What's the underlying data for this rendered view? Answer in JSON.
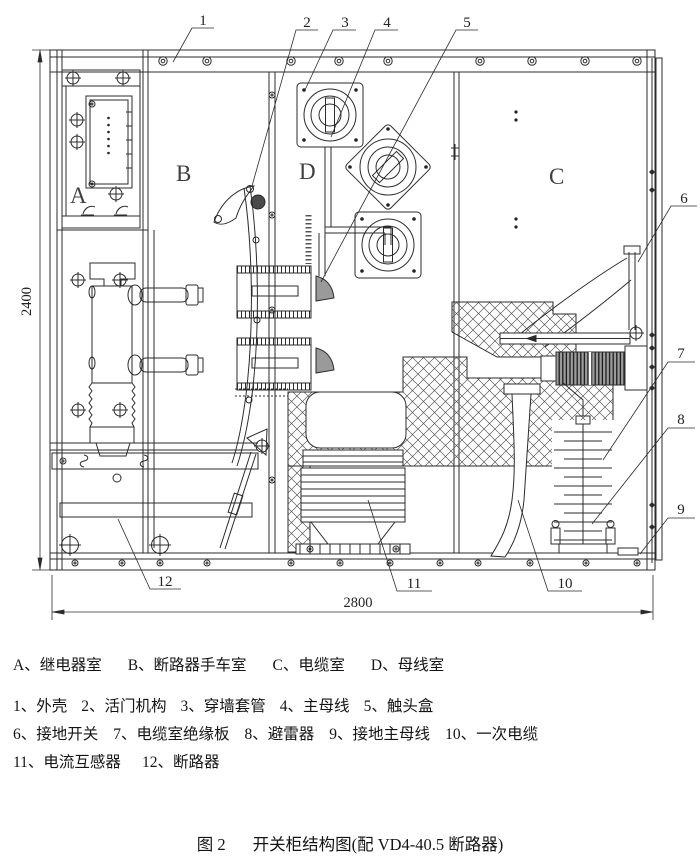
{
  "figure": {
    "dims": {
      "height_mm": "2400",
      "width_mm": "2800"
    },
    "compartments": [
      {
        "id": "A",
        "label": "A"
      },
      {
        "id": "B",
        "label": "B"
      },
      {
        "id": "D",
        "label": "D"
      },
      {
        "id": "C",
        "label": "C"
      }
    ],
    "callouts": {
      "c1": "1",
      "c2": "2",
      "c3": "3",
      "c4": "4",
      "c5": "5",
      "c6": "6",
      "c7": "7",
      "c8": "8",
      "c9": "9",
      "c10": "10",
      "c11": "11",
      "c12": "12"
    },
    "colors": {
      "line": "#2b2b2b",
      "hatch": "#555555",
      "metal": "#9c9c9c"
    }
  },
  "legend": {
    "rooms": [
      "A、继电器室",
      "B、断路器手车室",
      "C、电缆室",
      "D、母线室"
    ],
    "line1": [
      "1、外壳",
      "2、活门机构",
      "3、穿墙套管",
      "4、主母线",
      "5、触头盒"
    ],
    "line2": [
      "6、接地开关",
      "7、电缆室绝缘板",
      "8、避雷器",
      "9、接地主母线",
      "10、一次电缆"
    ],
    "line3": [
      "11、电流互感器",
      "12、断路器"
    ]
  },
  "caption": {
    "fig_no": "图 2",
    "title": "开关柜结构图(配 VD4-40.5 断路器)"
  }
}
